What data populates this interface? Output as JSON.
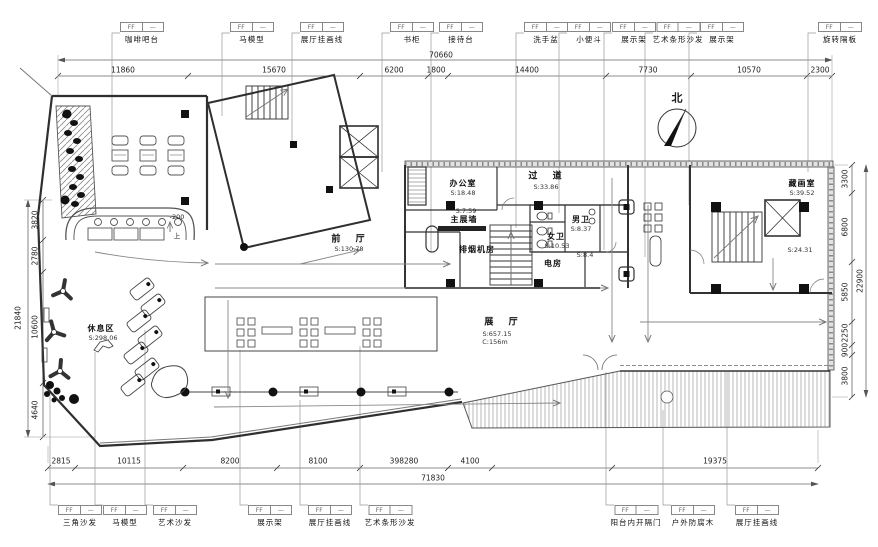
{
  "callout_tag": {
    "ff": "FF",
    "dash": "—"
  },
  "callouts_top": [
    {
      "label": "咖啡吧台"
    },
    {
      "label": "马模型"
    },
    {
      "label": "展厅挂画线"
    },
    {
      "label": "书柜"
    },
    {
      "label": "接待台"
    },
    {
      "label": "洗手盆"
    },
    {
      "label": "小便斗"
    },
    {
      "label": "展示架"
    },
    {
      "label": "艺术条形沙发"
    },
    {
      "label": "展示架"
    },
    {
      "label": "旋转隔板"
    }
  ],
  "callouts_bottom": [
    {
      "label": "三角沙发"
    },
    {
      "label": "马模型"
    },
    {
      "label": "艺术沙发"
    },
    {
      "label": "展示架"
    },
    {
      "label": "展厅挂画线"
    },
    {
      "label": "艺术条形沙发"
    },
    {
      "label": "阳台内开隔门"
    },
    {
      "label": "户外防腐木"
    },
    {
      "label": "展厅挂画线"
    }
  ],
  "dims": {
    "top": {
      "total": "70660",
      "segments": [
        "11860",
        "15670",
        "6200",
        "1800",
        "14400",
        "7730",
        "10570",
        "2300"
      ]
    },
    "bottom": {
      "total": "71830",
      "segments": [
        "2815",
        "10115",
        "8200",
        "8100",
        "398280",
        "4100",
        "19375"
      ]
    },
    "left": {
      "total": "21840",
      "segments": [
        "3820",
        "2780",
        "10600",
        "4640"
      ]
    },
    "right": {
      "total": "22900",
      "segments": [
        "3300",
        "6800",
        "5850",
        "2250",
        "900",
        "3800"
      ]
    }
  },
  "rooms": {
    "office": {
      "name": "办公室",
      "area": "S:18.48"
    },
    "corridor": {
      "name": "过 道",
      "area": "S:33.86"
    },
    "main_wall": {
      "name": "主展墙",
      "area": "S:7.59"
    },
    "mens": {
      "name": "男卫",
      "area": "S:8.37"
    },
    "womens": {
      "name": "女卫",
      "area": "S:10.53"
    },
    "smoke": {
      "name": "排烟机房"
    },
    "electrical": {
      "name": "电房"
    },
    "aux": {
      "area": "S:8.4"
    },
    "archive": {
      "name": "藏画室",
      "area": "S:39.52"
    },
    "archive_lower": {
      "area": "S:24.31"
    },
    "lobby": {
      "name": "前 厅",
      "area": "S:130.78"
    },
    "hall": {
      "name": "展 厅",
      "area": "S:657.15",
      "circulation": "C:156m"
    },
    "rest": {
      "name": "休息区",
      "area": "S:298.06"
    }
  },
  "marks": {
    "north": "北",
    "level": "-200",
    "up": "上"
  }
}
